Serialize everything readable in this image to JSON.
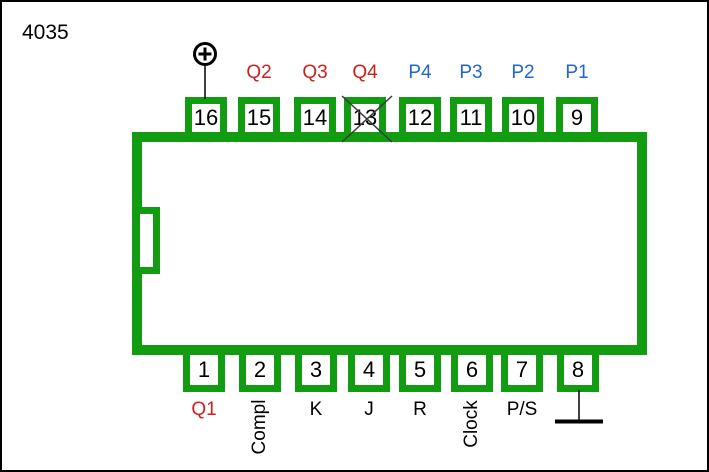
{
  "title": "4035",
  "colors": {
    "ic_green": "#119C11",
    "q_label_red": "#CC2020",
    "p_label_blue": "#2266CC",
    "text_black": "#000000"
  },
  "pins": {
    "top": [
      {
        "number": "16",
        "label": "",
        "symbol": "power-plus",
        "crossed": false
      },
      {
        "number": "15",
        "label": "Q2",
        "crossed": false
      },
      {
        "number": "14",
        "label": "Q3",
        "crossed": false
      },
      {
        "number": "13",
        "label": "Q4",
        "crossed": true
      },
      {
        "number": "12",
        "label": "P4",
        "crossed": false
      },
      {
        "number": "11",
        "label": "P3",
        "crossed": false
      },
      {
        "number": "10",
        "label": "P2",
        "crossed": false
      },
      {
        "number": "9",
        "label": "P1",
        "crossed": false
      }
    ],
    "bottom": [
      {
        "number": "1",
        "label": "Q1"
      },
      {
        "number": "2",
        "label": "Compl"
      },
      {
        "number": "3",
        "label": "K"
      },
      {
        "number": "4",
        "label": "J"
      },
      {
        "number": "5",
        "label": "R"
      },
      {
        "number": "6",
        "label": "Clock"
      },
      {
        "number": "7",
        "label": "P/S"
      },
      {
        "number": "8",
        "label": "",
        "symbol": "ground"
      }
    ]
  }
}
